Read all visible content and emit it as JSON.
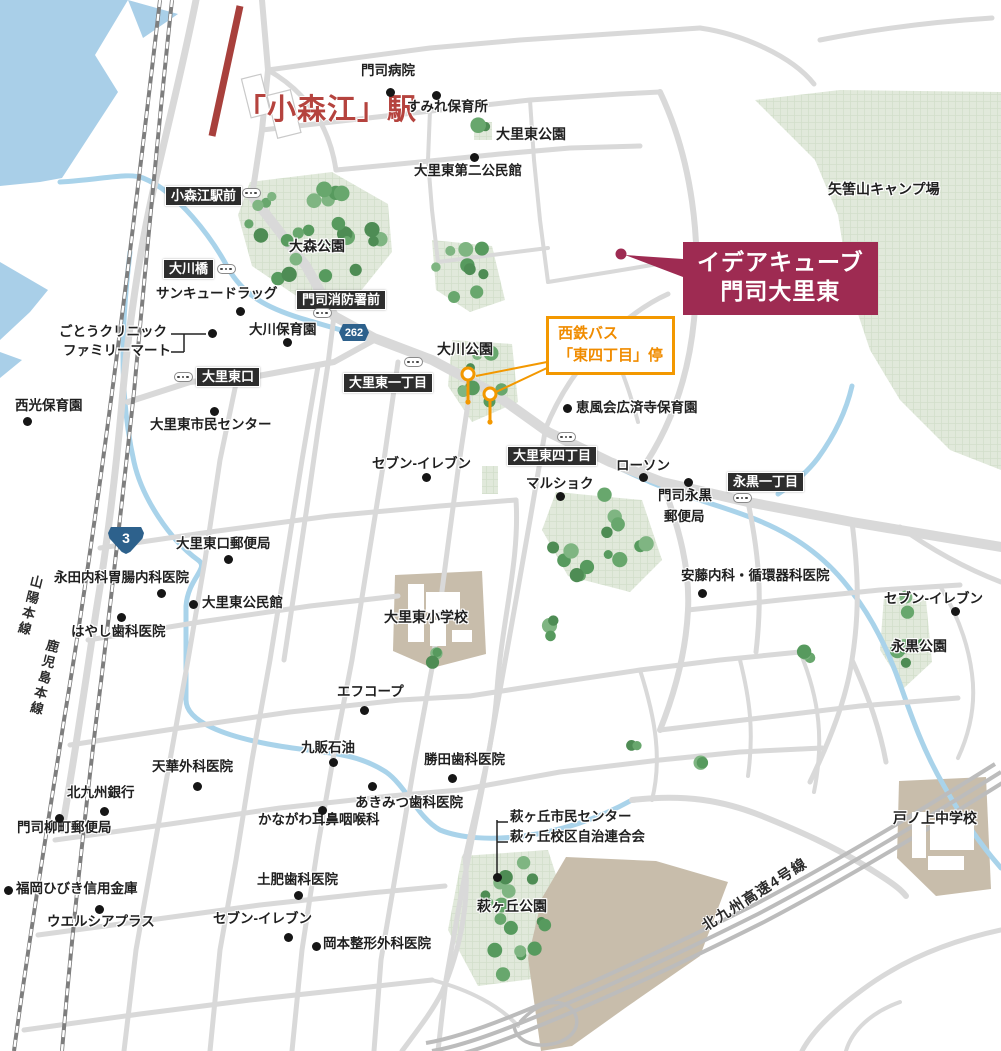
{
  "map": {
    "colors": {
      "water": "#a9cfe8",
      "river": "#a9d3ea",
      "green_area": "#e1e9db",
      "road": "#d9d9d9",
      "school_block": "#c8bdab",
      "road_sign_bg": "#2d2d2d",
      "property_accent": "#9e2b52",
      "station_red": "#b5433e",
      "bus_orange": "#f39800",
      "route_badge_blue": "#2d618c",
      "tree_greens": [
        "#4e8c54",
        "#68a76d",
        "#7fb582",
        "#579a5e"
      ]
    },
    "station": {
      "label": "「小森江」駅"
    },
    "property_callout": {
      "line1": "イデアキューブ",
      "line2": "門司大里東"
    },
    "bus_callout": {
      "line1": "西鉄バス",
      "line2": "「東四丁目」停"
    },
    "highway_label": {
      "text": "北九州高速4号線"
    },
    "rail_labels": [
      {
        "text": "山陽本線",
        "x": 20,
        "y": 574,
        "rot": 14
      },
      {
        "text": "鹿児島本線",
        "x": 34,
        "y": 638,
        "rot": 14
      }
    ],
    "route_badges": [
      {
        "text": "3",
        "type": "shield",
        "x": 108,
        "y": 527
      },
      {
        "text": "262",
        "type": "hex",
        "x": 339,
        "y": 324
      }
    ],
    "road_labels": [
      {
        "text": "小森江駅前",
        "x": 165,
        "y": 186
      },
      {
        "text": "大川橋",
        "x": 163,
        "y": 259
      },
      {
        "text": "門司消防署前",
        "x": 296,
        "y": 290
      },
      {
        "text": "大里東口",
        "x": 196,
        "y": 367
      },
      {
        "text": "大里東一丁目",
        "x": 343,
        "y": 373
      },
      {
        "text": "大里東四丁目",
        "x": 507,
        "y": 446
      },
      {
        "text": "永黒一丁目",
        "x": 727,
        "y": 472
      }
    ],
    "area_labels": [
      {
        "text": "大里東公園",
        "x": 496,
        "y": 127
      },
      {
        "text": "大森公園",
        "x": 289,
        "y": 239
      },
      {
        "text": "大川公園",
        "x": 437,
        "y": 342
      },
      {
        "text": "矢筈山キャンプ場",
        "x": 828,
        "y": 182
      },
      {
        "text": "永黒公園",
        "x": 891,
        "y": 639
      },
      {
        "text": "大里東小学校",
        "x": 384,
        "y": 610
      },
      {
        "text": "萩ヶ丘公園",
        "x": 477,
        "y": 899
      },
      {
        "text": "戸ノ上中学校",
        "x": 893,
        "y": 811
      }
    ],
    "poi_labels": [
      {
        "text": "門司病院",
        "x": 361,
        "y": 64,
        "dot": [
          390,
          92
        ]
      },
      {
        "text": "すみれ保育所",
        "x": 407,
        "y": 100,
        "dot": [
          436,
          95
        ]
      },
      {
        "text": "大里東第二公民館",
        "x": 414,
        "y": 164,
        "dot": [
          474,
          157
        ]
      },
      {
        "text": "サンキュードラッグ",
        "x": 156,
        "y": 287,
        "dot": [
          240,
          311
        ]
      },
      {
        "text": "大川保育園",
        "x": 249,
        "y": 323,
        "dot": [
          287,
          342
        ]
      },
      {
        "text": "ごとうクリニック",
        "x": 59,
        "y": 325
      },
      {
        "text": "ファミリーマート",
        "x": 63,
        "y": 344
      },
      {
        "text": "西光保育園",
        "x": 15,
        "y": 399,
        "dot": [
          27,
          421
        ]
      },
      {
        "text": "大里東市民センター",
        "x": 150,
        "y": 418,
        "dot": [
          214,
          411
        ]
      },
      {
        "text": "恵風会広済寺保育園",
        "x": 576,
        "y": 401,
        "dot": [
          567,
          408
        ]
      },
      {
        "text": "セブン-イレブン",
        "x": 372,
        "y": 457,
        "dot": [
          426,
          477
        ]
      },
      {
        "text": "マルショク",
        "x": 526,
        "y": 477,
        "dot": [
          560,
          496
        ]
      },
      {
        "text": "ローソン",
        "x": 616,
        "y": 459,
        "dot": [
          643,
          477
        ]
      },
      {
        "text": "門司永黒",
        "x": 658,
        "y": 489,
        "dot": [
          688,
          482
        ]
      },
      {
        "text": "郵便局",
        "x": 664,
        "y": 510
      },
      {
        "text": "安藤内科・循環器科医院",
        "x": 681,
        "y": 569,
        "dot": [
          702,
          593
        ]
      },
      {
        "text": "セブン-イレブン",
        "x": 884,
        "y": 592,
        "dot": [
          955,
          611
        ]
      },
      {
        "text": "大里東口郵便局",
        "x": 176,
        "y": 537,
        "dot": [
          228,
          559
        ]
      },
      {
        "text": "永田内科胃腸内科医院",
        "x": 54,
        "y": 571,
        "dot": [
          161,
          593
        ]
      },
      {
        "text": "大里東公民館",
        "x": 202,
        "y": 596,
        "dot": [
          193,
          604
        ]
      },
      {
        "text": "はやし歯科医院",
        "x": 71,
        "y": 625,
        "dot": [
          121,
          617
        ]
      },
      {
        "text": "エフコープ",
        "x": 337,
        "y": 685,
        "dot": [
          364,
          710
        ]
      },
      {
        "text": "九販石油",
        "x": 301,
        "y": 741,
        "dot": [
          333,
          762
        ]
      },
      {
        "text": "勝田歯科医院",
        "x": 424,
        "y": 753,
        "dot": [
          452,
          778
        ]
      },
      {
        "text": "天華外科医院",
        "x": 152,
        "y": 760,
        "dot": [
          197,
          786
        ]
      },
      {
        "text": "北九州銀行",
        "x": 67,
        "y": 786,
        "dot": [
          104,
          811
        ]
      },
      {
        "text": "門司柳町郵便局",
        "x": 17,
        "y": 821,
        "dot": [
          59,
          818
        ]
      },
      {
        "text": "あきみつ歯科医院",
        "x": 355,
        "y": 796,
        "dot": [
          372,
          786
        ]
      },
      {
        "text": "かながわ耳鼻咽喉科",
        "x": 258,
        "y": 813,
        "dot": [
          322,
          810
        ]
      },
      {
        "text": "福岡ひびき信用金庫",
        "x": 16,
        "y": 882,
        "dot": [
          8,
          890
        ]
      },
      {
        "text": "ウエルシアプラス",
        "x": 47,
        "y": 915,
        "dot": [
          99,
          909
        ]
      },
      {
        "text": "土肥歯科医院",
        "x": 257,
        "y": 873,
        "dot": [
          298,
          895
        ]
      },
      {
        "text": "セブン-イレブン",
        "x": 213,
        "y": 912,
        "dot": [
          288,
          937
        ]
      },
      {
        "text": "岡本整形外科医院",
        "x": 323,
        "y": 937,
        "dot": [
          316,
          946
        ]
      },
      {
        "text": "萩ヶ丘市民センター",
        "x": 510,
        "y": 810
      },
      {
        "text": "萩ヶ丘校区自治連合会",
        "x": 510,
        "y": 830
      }
    ],
    "bus_stops": [
      [
        251,
        193
      ],
      [
        226,
        269
      ],
      [
        322,
        313
      ],
      [
        183,
        377
      ],
      [
        413,
        362
      ],
      [
        566,
        437
      ],
      [
        742,
        498
      ]
    ],
    "extra_dots": [
      [
        212,
        333
      ],
      [
        497,
        877
      ]
    ]
  }
}
